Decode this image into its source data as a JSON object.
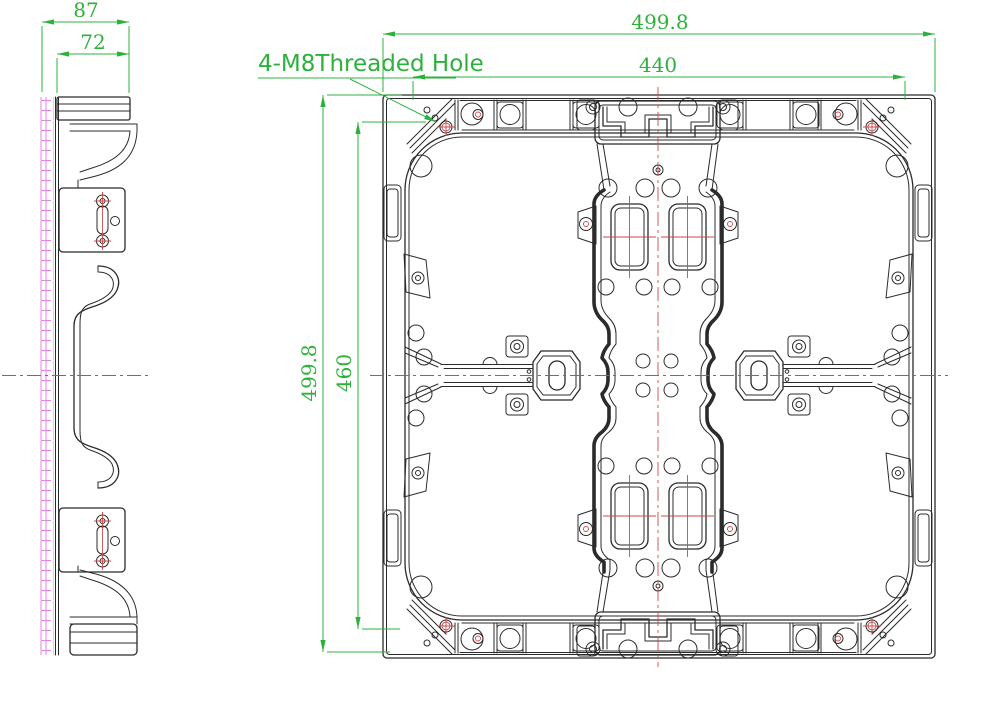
{
  "drawing": {
    "title_annotation": "4-M8Threaded Hole",
    "side_view": {
      "name": "side-profile-view",
      "dimensions": [
        {
          "id": "overall_depth",
          "value": "87"
        },
        {
          "id": "flange_depth",
          "value": "72"
        }
      ]
    },
    "front_view": {
      "name": "cabinet-rear-view",
      "dimensions": [
        {
          "id": "overall_width",
          "value": "499.8"
        },
        {
          "id": "hole_spacing_width",
          "value": "440"
        },
        {
          "id": "overall_height",
          "value": "499.8"
        },
        {
          "id": "inner_height",
          "value": "460"
        }
      ]
    },
    "colors": {
      "line": "#2b2b2b",
      "dimension": "#2eb13c",
      "centerline": "#c84b4b",
      "hatch": "#e583e5",
      "background": "#ffffff"
    }
  }
}
